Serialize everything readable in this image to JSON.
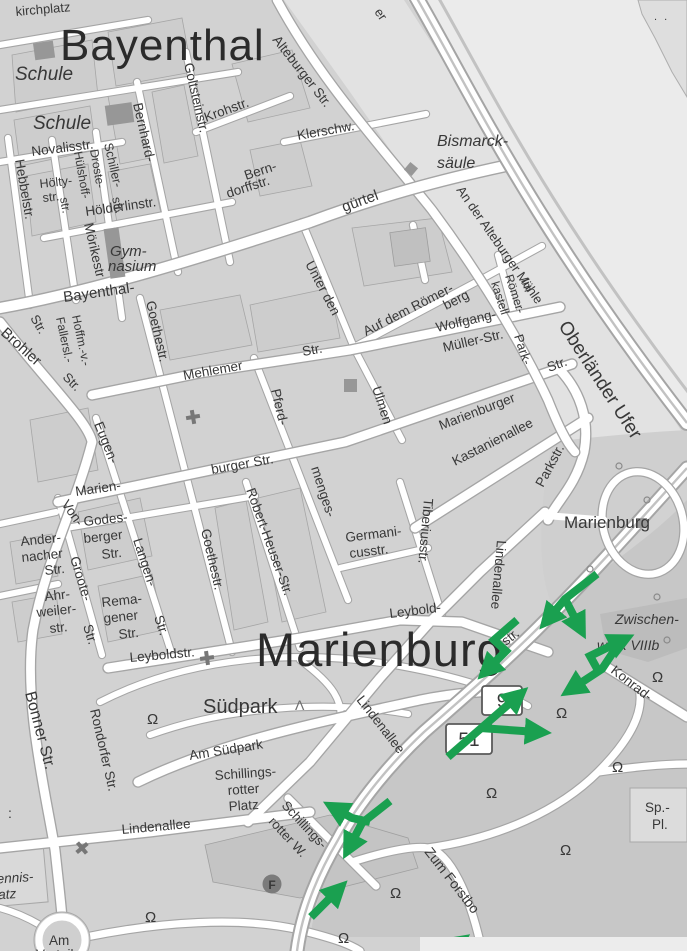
{
  "districts": {
    "bayenthal": "Bayenthal",
    "marienburg": "Marienburg"
  },
  "areas": {
    "schule": "Schule",
    "gymnasium_line1": "Gym-",
    "gymnasium_line2": "nasium",
    "bismarck_line1": "Bismarck-",
    "bismarck_line2": "säule",
    "suedpark": "Südpark",
    "marienburg_park": "Marienburg",
    "zwischenwerk_line1": "Zwischen-",
    "zwischenwerk_line2": "werk VIIIb",
    "sportplatz_line1": "Sp.-",
    "sportplatz_line2": "Pl.",
    "tennis_line1": "Tennis-",
    "tennis_line2": "platz",
    "roundabout_line1": "Am",
    "roundabout_line2": "Verteiler"
  },
  "streets": {
    "kirchplatz": "kirchplatz",
    "alteburger": "Alteburger Str.",
    "an_der_alteburger": "An der Alteburger Mühle",
    "fragment_er": "er",
    "goltstein": "Goltsteinstr.",
    "kroh": "Krohstr.",
    "klerschw": "Klerschw.",
    "bernhard": "Bernhard-",
    "berndorff1": "Bern-",
    "berndorff2": "dorffstr.",
    "novalis": "Novalisstr.",
    "hebbel": "Hebbelstr.",
    "hoelty": "Hölty-",
    "droste1": "Droste-",
    "droste2": "Hülshoff-",
    "schiller": "Schiller-",
    "hoelderlin": "Hölderlinstr.",
    "moerike": "Mörikestr",
    "guertel": "gürtel",
    "bayenthal_guertel": "Bayenthal-",
    "unter_den": "Unter den",
    "ulmen": "Ulmen",
    "roemerberg1": "Auf dem Römer-",
    "roemerberg2": "berg",
    "im": "Im",
    "roemerkastell1": "Römer-",
    "roemerkastell2": "kastell",
    "wolfgang1": "Wolfgang-",
    "wolfgang2": "Müller-Str.",
    "park_part": "Park-",
    "marienburger": "Marienburger",
    "kastanienallee": "Kastanienallee",
    "parkstr": "Parkstr.",
    "oberlaender": "Oberländer Ufer",
    "germanicus1": "Germani-",
    "germanicus2": "cusstr.",
    "tiberius": "Tiberiusstr.",
    "lindenallee": "Lindenallee",
    "leybold1": "Leybold-",
    "leyboldstr": "Leyboldstr.",
    "bonner": "Bonner Str.",
    "rondorfer": "Rondorfer Str.",
    "am_suedpark": "Am Südpark",
    "schillingsrotter1": "Schillings-",
    "schillingsrotter2": "rotter",
    "schillingsrotter3": "Platz",
    "schillingsrotter_w2": "rotter W.",
    "zum_forstbo": "Zum Forstbo",
    "konrad": "Konrad-",
    "mehlemer": "Mehlemer",
    "brohler": "Brohler",
    "hoffm": "Hoffm.-v.-",
    "fallersl": "Fallersl.-",
    "goethe": "Goethestr.",
    "eugen": "Eugen-",
    "langen": "Langen-",
    "von": "Von-",
    "groote": "Groote-",
    "marien": "Marien-",
    "burger": "burger Str.",
    "godes1": "Godes-",
    "godes2": "berger",
    "ander1": "Ander-",
    "ander2": "nacher",
    "ahr1": "Ahr-",
    "ahr2": "weiler-",
    "rema1": "Rema-",
    "rema2": "gener",
    "robert_heuser": "Robert-Heuser-Str.",
    "menges": "menges-",
    "pferd": "Pferd-",
    "str_cap": "Str.",
    "str_low": "str."
  },
  "shields": {
    "b9": "9",
    "b51": "51"
  },
  "symbols": {
    "tree": "Ω",
    "conifer": "Λ",
    "facility": "F",
    "island_dots": ". .",
    "colon": ":"
  },
  "colors": {
    "arrow_green": "#1aa050",
    "road_fill": "#ffffff",
    "road_casing": "#a5a5a5",
    "block_gray": "#d2d2d2",
    "river_gray": "#ebebeb",
    "dark_area": "#c7c7c7",
    "label_dark": "#383838"
  }
}
